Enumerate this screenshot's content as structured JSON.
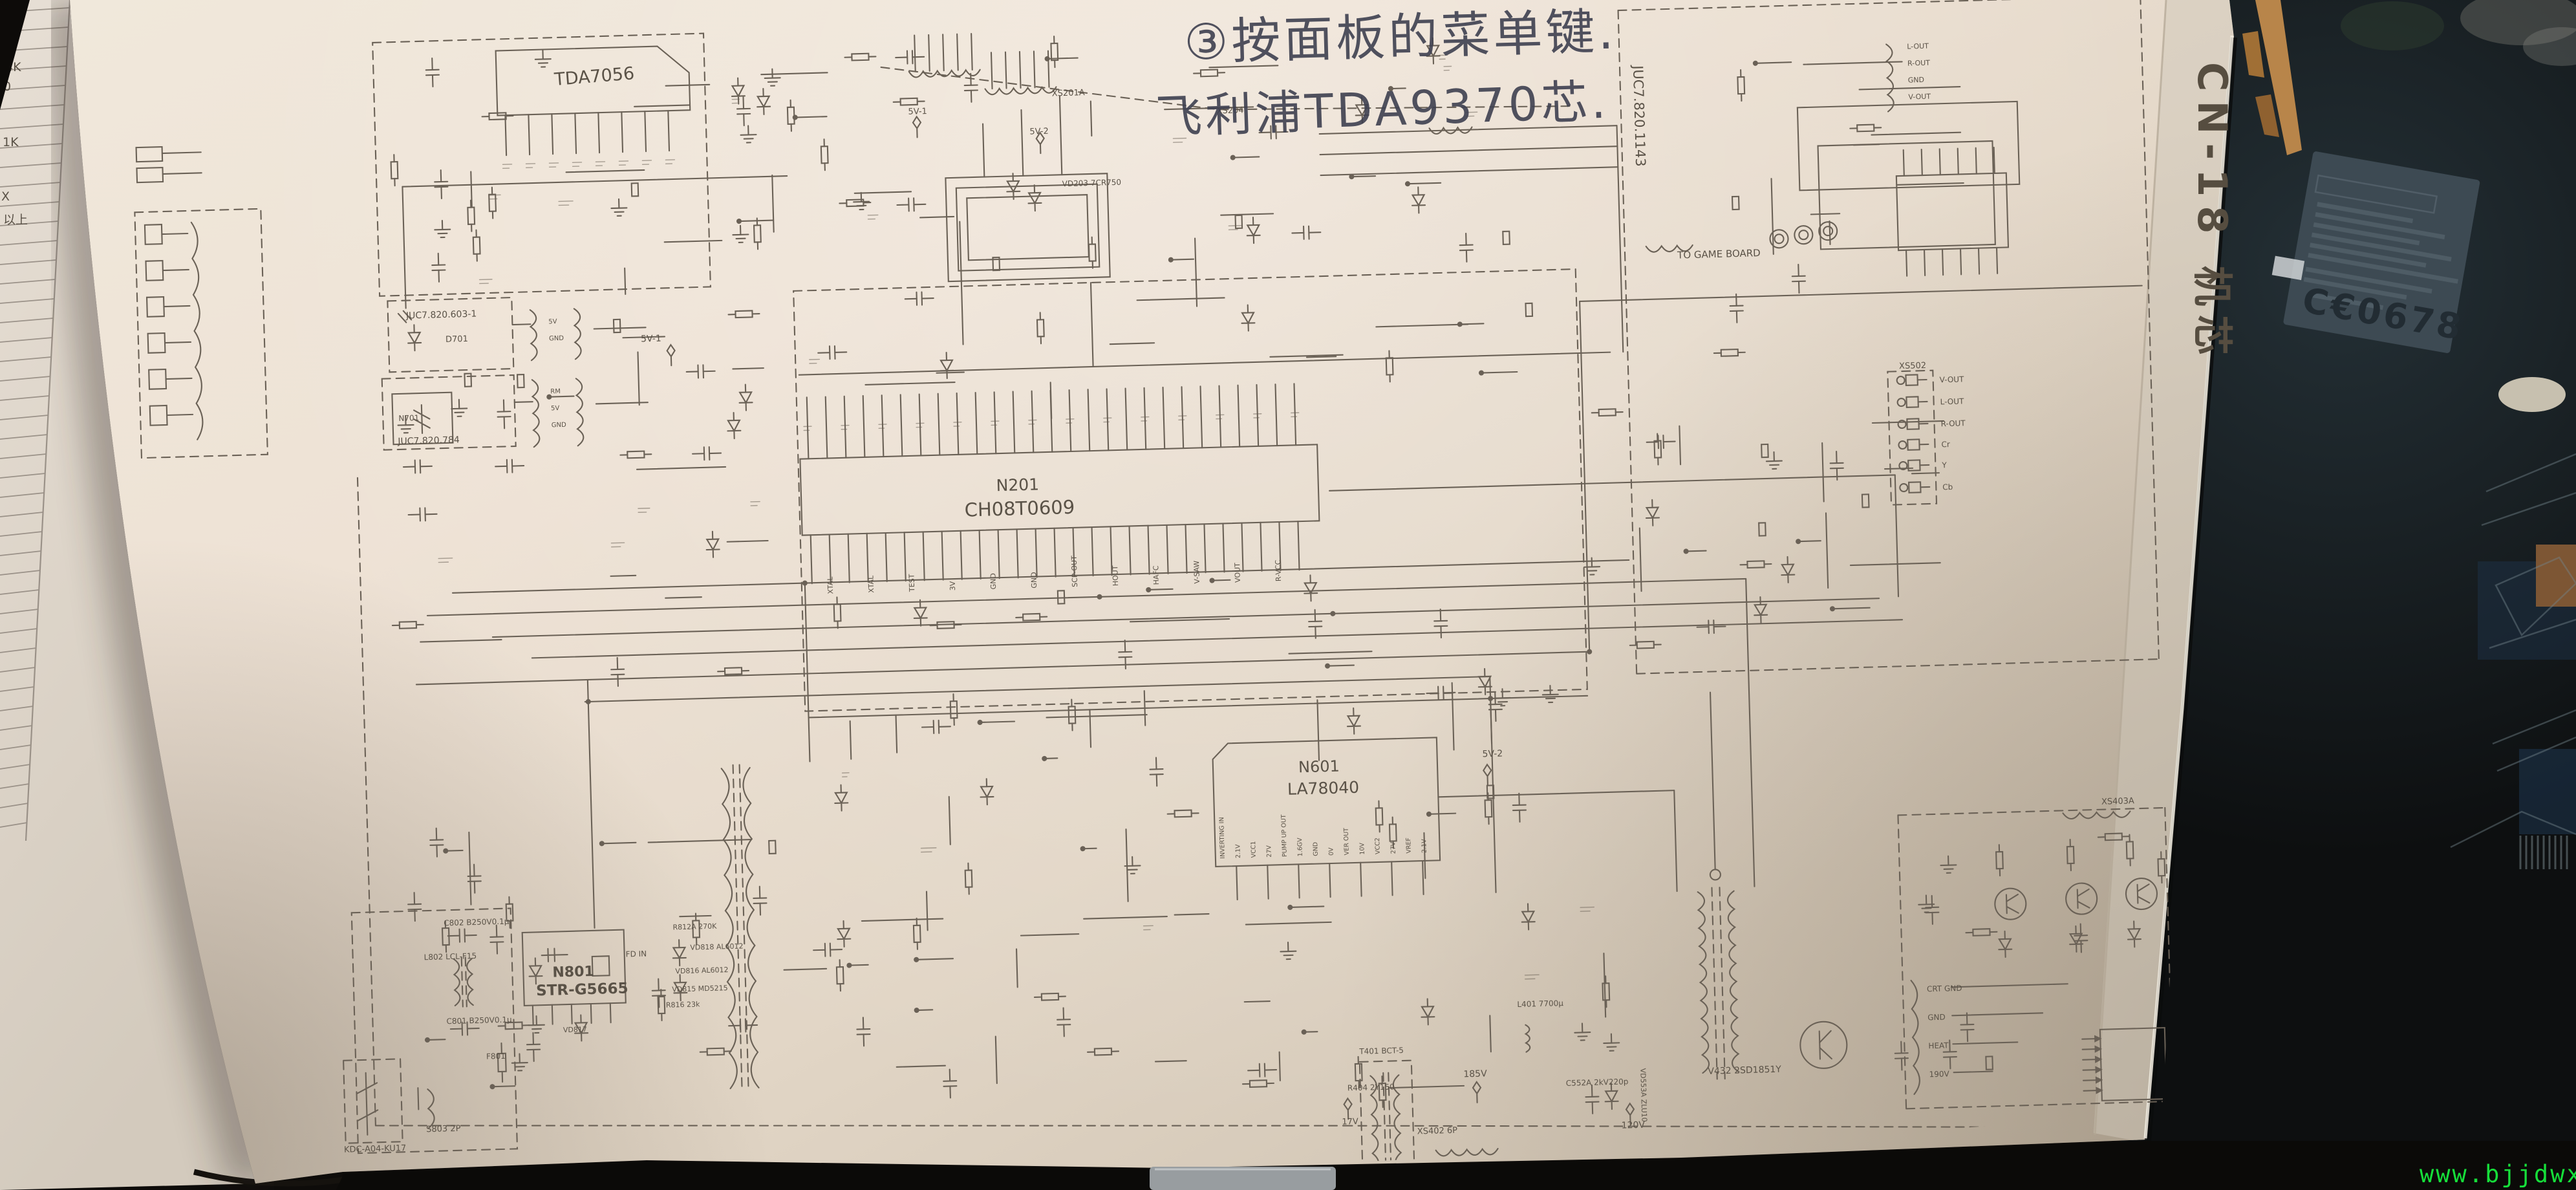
{
  "photo": {
    "handwriting_line1": "③按面板的菜单键.",
    "handwriting_line2": "飞利浦TDA9370芯.",
    "margin_label": "CN-18 机芯",
    "watermark": "www.bjjdwx.com",
    "ce_mark": "C€0678"
  },
  "left_page": {
    "fragments": [
      "∞",
      "∞",
      "0",
      "4K",
      "0",
      "1K",
      "X",
      "以上"
    ]
  },
  "schematic": {
    "audio_ic": "TDA7056",
    "main_ic_ref": "N201",
    "main_ic_part": "CH08T0609",
    "main_ic_pins": [
      "XTAL",
      "XTAL",
      "TEST",
      "3V",
      "GND",
      "GND",
      "SCP-OUT",
      "HOUT",
      "HAFC",
      "V-SAW",
      "VOUT",
      "R-VCC"
    ],
    "vert_ic_ref": "N601",
    "vert_ic_part": "LA78040",
    "vert_ic_pins": [
      "INVERTING IN",
      "2.1V",
      "VCC1",
      "27V",
      "PUMP UP OUT",
      "1.6GV",
      "GND",
      "0V",
      "VER OUT",
      "10V",
      "VCC2",
      "27V",
      "VREF",
      "2.1V"
    ],
    "psu_ic_ref": "N801",
    "psu_ic_part": "STR-G5665",
    "psu_ic_pin": "FD IN",
    "board_code": "JUC7.820.1143",
    "led_board_code": "JUC7.820.603-1",
    "remote_board_code": "JUC7.820.784",
    "led_ref": "D701",
    "remote_ic": "N701",
    "remote_pins": [
      "5V",
      "GND",
      "RM",
      "5V",
      "GND"
    ],
    "to_game_board": "TO GAME BOARD",
    "game_in_pins": [
      "L-OUT",
      "R-OUT",
      "GND",
      "V-OUT"
    ],
    "av_jacks_ref": "XS502",
    "av_jack_labels": [
      "V-OUT",
      "L-OUT",
      "R-OUT",
      "Cr",
      "Y",
      "Cb"
    ],
    "conn_xs201a": "XS201A",
    "conn_xs204": "XS204",
    "conn_xs402": "XS402 6P",
    "conn_xs402_pins": [
      "HEAT",
      "GND",
      "GND",
      "190V"
    ],
    "conn_s803": "S803 2P",
    "conn_xs403": "XS403A",
    "crt_conn_pins": [
      "CRT GND",
      "GND",
      "HEAT",
      "190V"
    ],
    "switch_part": "KDC-A04-KU17",
    "v5_1": "5V-1",
    "v5_2": "5V-2",
    "v185": "185V",
    "v17": "17V",
    "v120": "120V",
    "keypad_part": "VD203 7CR750",
    "line_filter": "L802 LCL-F15",
    "cap_c802": "C802 B250V0.1μ",
    "cap_c801": "C801 B250V0.1μ",
    "fuse": "F801",
    "t401": "T401 BCT-5",
    "l401": "L401 7700μ",
    "r404": "R404 2Y150",
    "c552": "C552A 2kV220p",
    "vd553": "VD553A ZLU10",
    "hout_tr": "V432 2SD1851Y",
    "vd818": "VD818 AL6012",
    "vd816": "VD816 AL6012",
    "vd815": "VD815 MD5215",
    "vd817": "VD817",
    "r816": "R816 23k",
    "r812": "R812A 270K"
  }
}
